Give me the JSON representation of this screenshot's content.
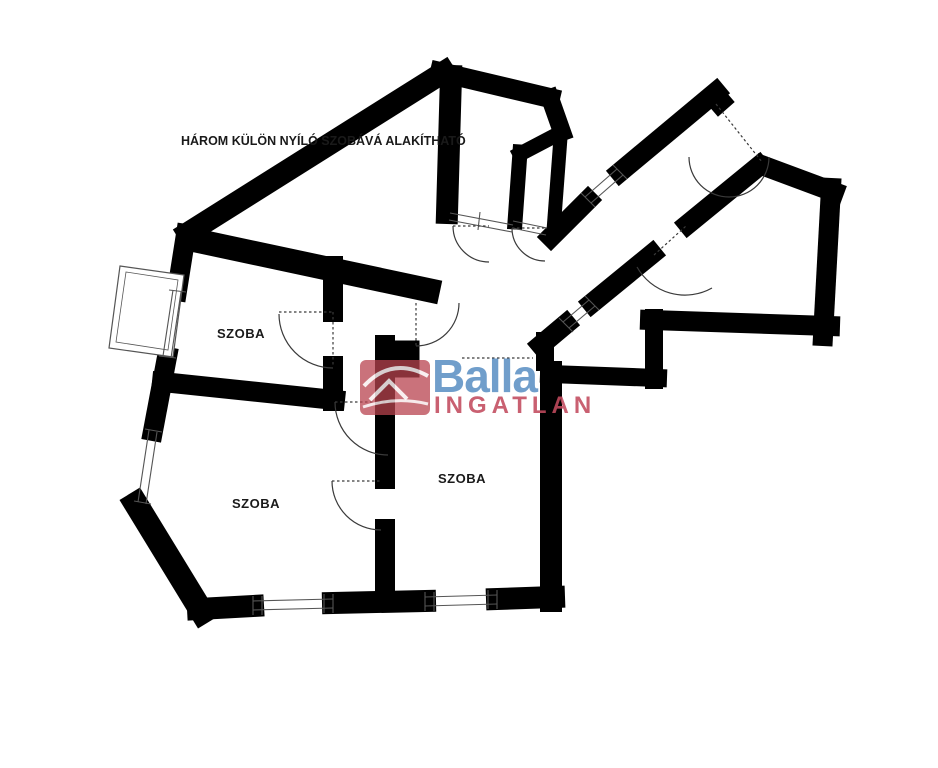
{
  "title": {
    "text": "HÁROM KÜLÖN NYÍLÓ SZOBÁVÁ ALAKÍTHATÓ"
  },
  "rooms": [
    {
      "label": "SZOBA"
    },
    {
      "label": "SZOBA"
    },
    {
      "label": "SZOBA"
    }
  ],
  "logo": {
    "brand": "Balla",
    "subtitle": "INGATLAN",
    "brand_color": "#5d91c4",
    "subtitle_color": "#c24b5e",
    "house_color": "#b9434f"
  },
  "colors": {
    "wall": "#000000",
    "line": "#3a3a3a",
    "thin": "#555555",
    "text": "#1a1a1a"
  }
}
